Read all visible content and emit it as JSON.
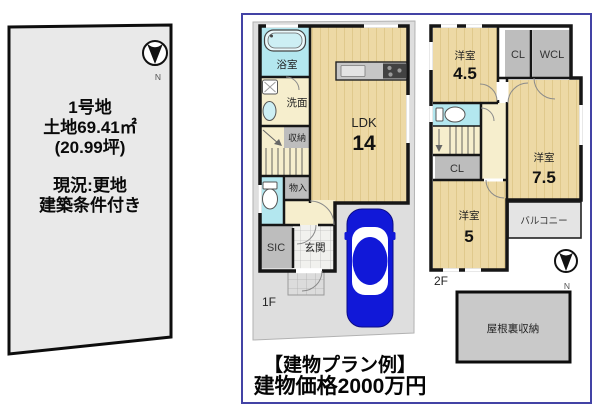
{
  "land_panel": {
    "compass_label": "N",
    "plot_name": "1号地",
    "area_m2": "土地69.41㎡",
    "area_tsubo": "(20.99坪)",
    "status": "現況:更地",
    "condition": "建築条件付き"
  },
  "plan_panel": {
    "floor1": {
      "floor_label": "1F",
      "bath": "浴室",
      "washroom": "洗面",
      "storage": "収納",
      "ldk_label": "LDK",
      "ldk_size": "14",
      "closet": "物入",
      "shoe_closet": "SIC",
      "entrance": "玄関"
    },
    "floor2": {
      "floor_label": "2F",
      "compass_label": "N",
      "bedroom_a_label": "洋室",
      "bedroom_a_size": "4.5",
      "bedroom_b_label": "洋室",
      "bedroom_b_size": "7.5",
      "bedroom_c_label": "洋室",
      "bedroom_c_size": "5",
      "closet_top": "CL",
      "walk_in_closet": "WCL",
      "closet_mid": "CL",
      "balcony": "バルコニー"
    },
    "attic_label": "屋根裏収納",
    "caption": {
      "line1": "【建物プラン例】",
      "line2": "建物価格2000万円"
    }
  },
  "colors": {
    "panel_border": "#4343a5",
    "wall": "#161616",
    "wood_floor": "#edd9a5",
    "wet_area": "#b3e7ef",
    "closet_gray": "#bdbdbd",
    "site_gray": "#dedede",
    "car_blue": "#1118d8"
  }
}
